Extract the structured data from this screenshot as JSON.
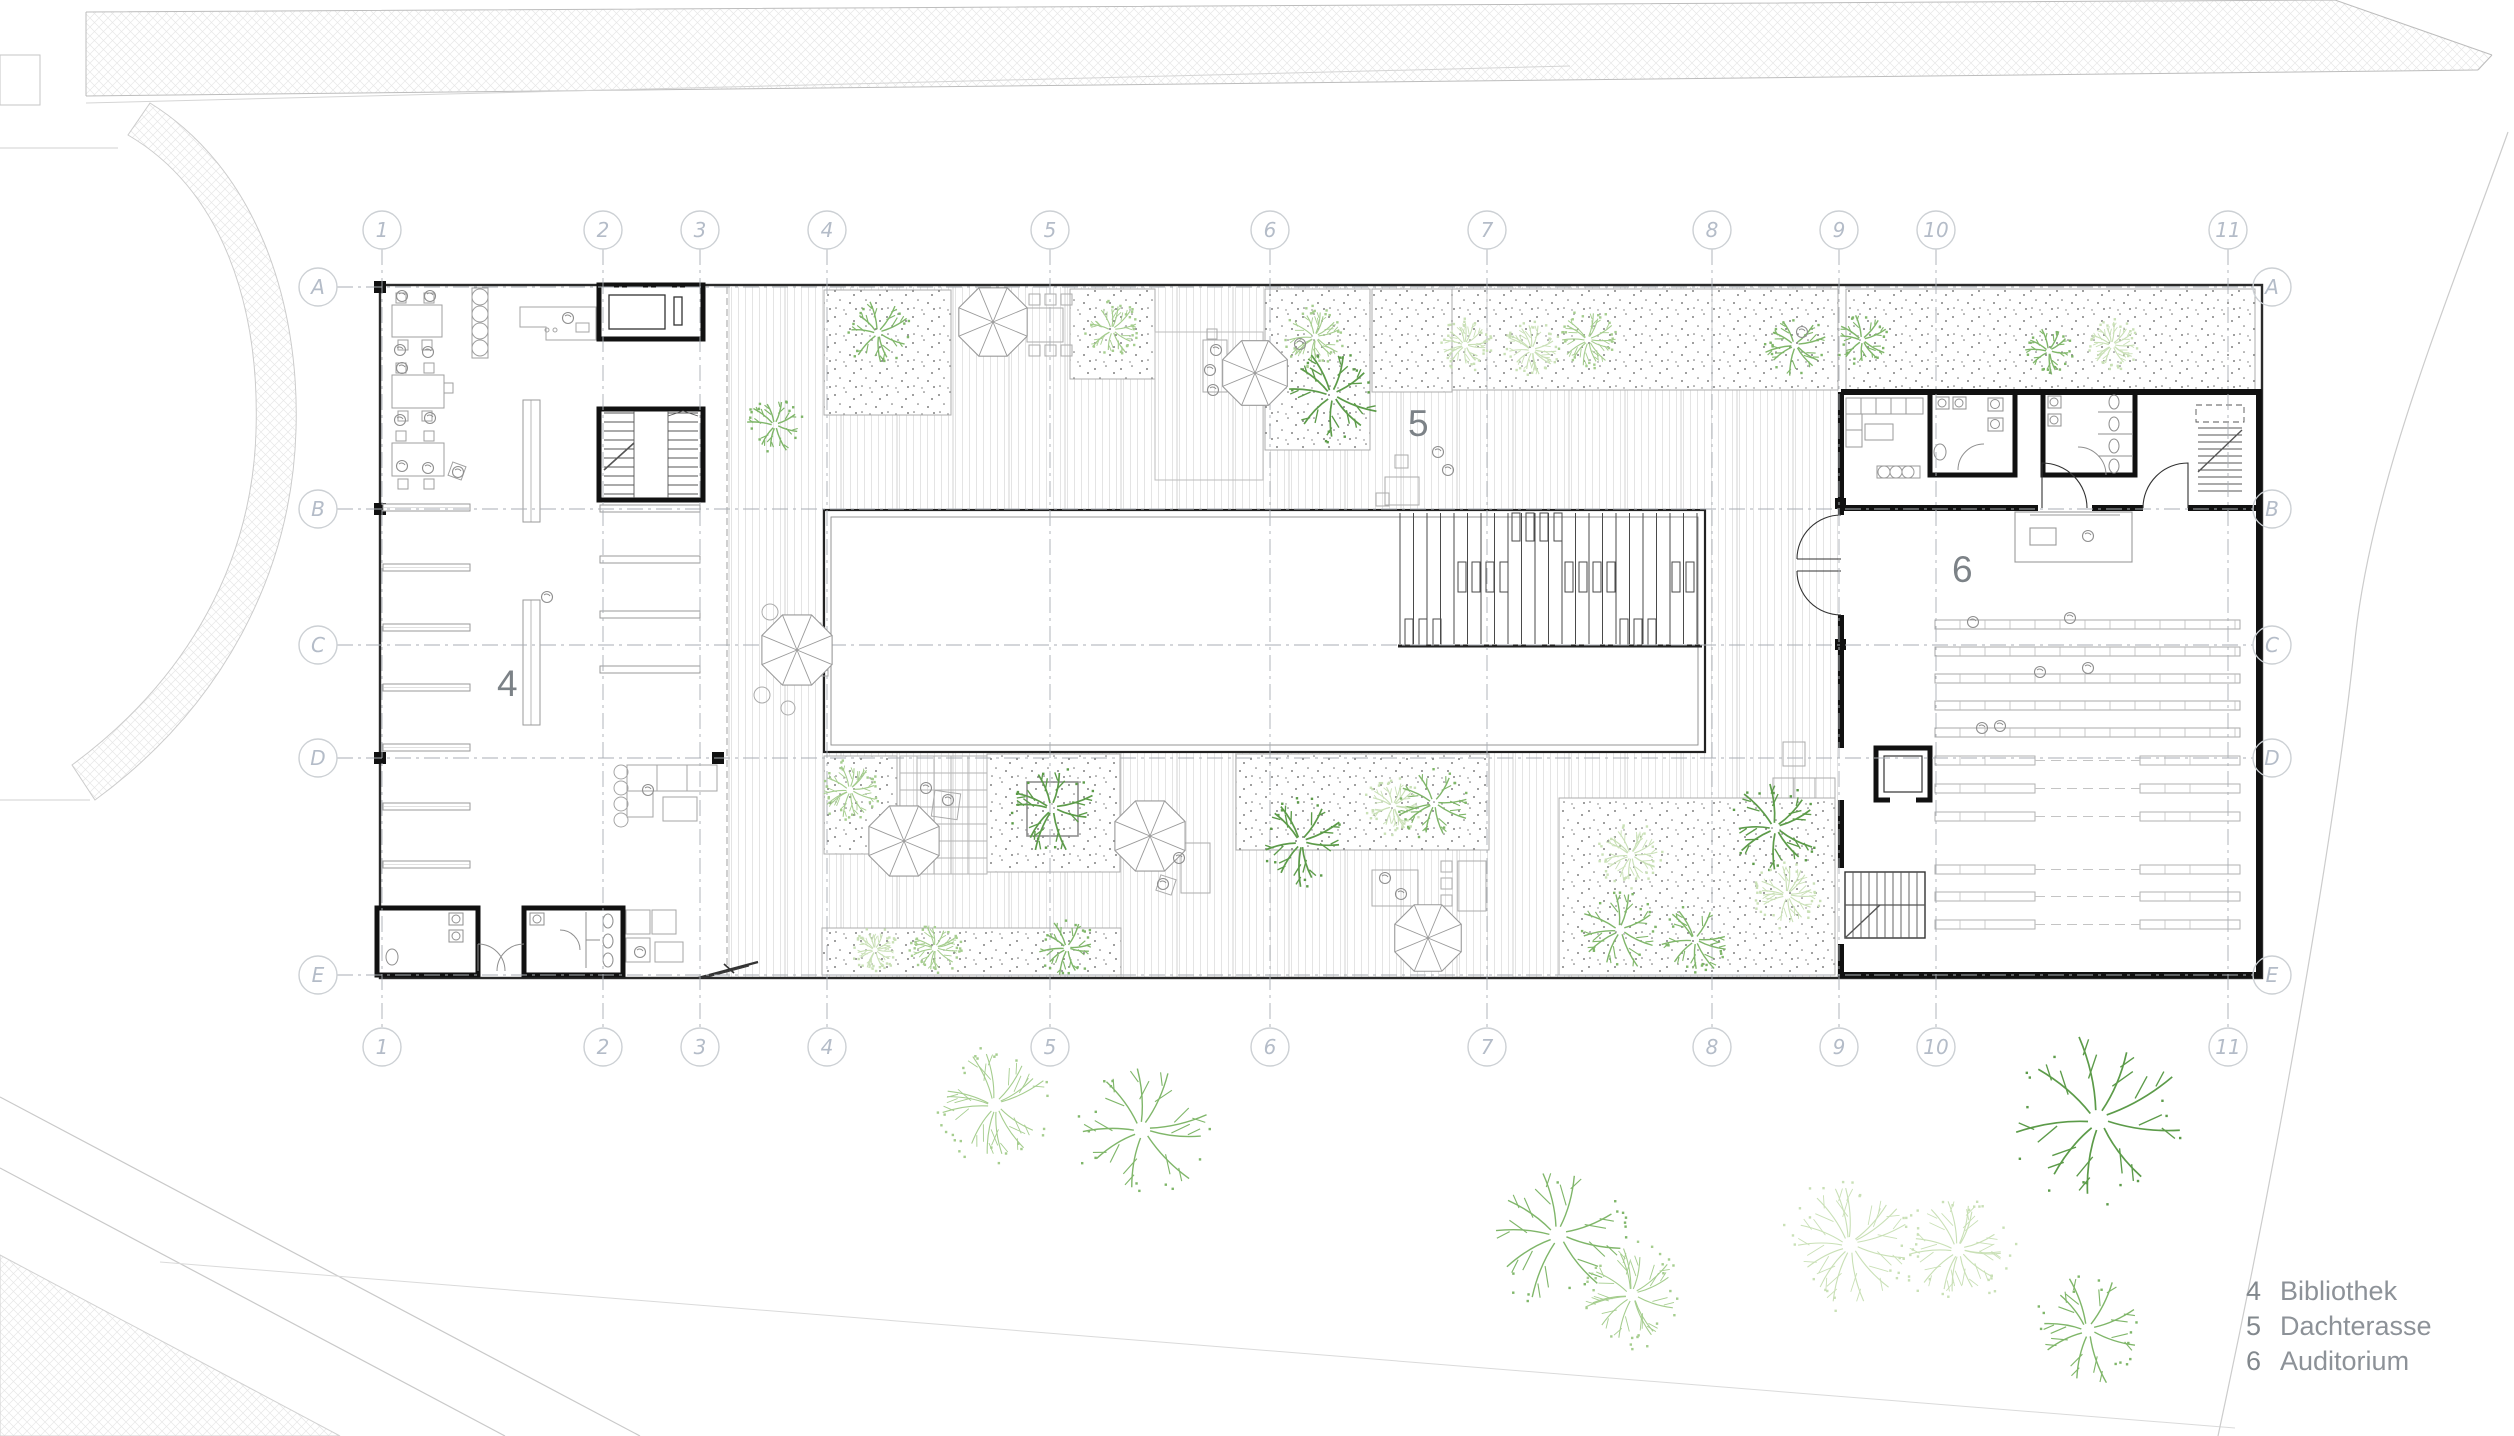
{
  "legend": {
    "items": [
      {
        "num": "4",
        "label": "Bibliothek"
      },
      {
        "num": "5",
        "label": "Dachterasse"
      },
      {
        "num": "6",
        "label": "Auditorium"
      }
    ]
  },
  "area_labels": [
    {
      "text": "4",
      "x": 497,
      "y": 696
    },
    {
      "text": "5",
      "x": 1408,
      "y": 436
    },
    {
      "text": "6",
      "x": 1952,
      "y": 582
    }
  ],
  "grid": {
    "columns": [
      {
        "label": "1",
        "x": 382
      },
      {
        "label": "2",
        "x": 603
      },
      {
        "label": "3",
        "x": 700
      },
      {
        "label": "4",
        "x": 827
      },
      {
        "label": "5",
        "x": 1050
      },
      {
        "label": "6",
        "x": 1270
      },
      {
        "label": "7",
        "x": 1487
      },
      {
        "label": "8",
        "x": 1712
      },
      {
        "label": "9",
        "x": 1839
      },
      {
        "label": "10",
        "x": 1936
      },
      {
        "label": "11",
        "x": 2228
      }
    ],
    "rows": [
      {
        "label": "A",
        "y": 287
      },
      {
        "label": "B",
        "y": 509
      },
      {
        "label": "C",
        "y": 645
      },
      {
        "label": "D",
        "y": 758
      },
      {
        "label": "E",
        "y": 975
      }
    ],
    "bubble_radius": 19,
    "top_bubble_y": 230,
    "bottom_bubble_y": 1047,
    "left_bubble_x": 318,
    "right_bubble_x": 2272
  },
  "colors": {
    "wall": "#1d1d1d",
    "line_medium": "#8f8f8f",
    "line_light": "#c9c9c9",
    "grid_line": "#a9aeb4",
    "bubble_stroke": "#ccd0d4",
    "bubble_text": "#b4bcc8",
    "area_label": "#7c8287",
    "legend_text": "#8d9298",
    "tree_dark": "#5c9b49",
    "tree_medium": "#7fb669",
    "tree_light": "#a5cd8e",
    "tree_verylight": "#c9e0b6"
  },
  "landscape": {
    "umbrellas": [
      {
        "x": 993,
        "y": 322,
        "r": 37
      },
      {
        "x": 1255,
        "y": 373,
        "r": 35
      },
      {
        "x": 797,
        "y": 650,
        "r": 38
      },
      {
        "x": 904,
        "y": 841,
        "r": 38
      },
      {
        "x": 1150,
        "y": 836,
        "r": 38
      },
      {
        "x": 1428,
        "y": 938,
        "r": 36
      }
    ],
    "trees": [
      {
        "x": 878,
        "y": 333,
        "r": 32,
        "type": "branch-med"
      },
      {
        "x": 1112,
        "y": 330,
        "r": 28,
        "type": "leafy-light"
      },
      {
        "x": 1315,
        "y": 337,
        "r": 30,
        "type": "leafy-light"
      },
      {
        "x": 1332,
        "y": 395,
        "r": 46,
        "type": "branch-dark"
      },
      {
        "x": 1465,
        "y": 345,
        "r": 26,
        "type": "leafy-vlight"
      },
      {
        "x": 1532,
        "y": 350,
        "r": 28,
        "type": "leafy-vlight"
      },
      {
        "x": 1588,
        "y": 340,
        "r": 30,
        "type": "leafy-light"
      },
      {
        "x": 1795,
        "y": 345,
        "r": 31,
        "type": "branch-med"
      },
      {
        "x": 1862,
        "y": 340,
        "r": 26,
        "type": "branch-med"
      },
      {
        "x": 2049,
        "y": 351,
        "r": 24,
        "type": "branch-med"
      },
      {
        "x": 2112,
        "y": 345,
        "r": 26,
        "type": "leafy-vlight"
      },
      {
        "x": 775,
        "y": 425,
        "r": 28,
        "type": "branch-med"
      },
      {
        "x": 850,
        "y": 790,
        "r": 30,
        "type": "leafy-light"
      },
      {
        "x": 1052,
        "y": 808,
        "r": 44,
        "type": "branch-dark"
      },
      {
        "x": 875,
        "y": 950,
        "r": 22,
        "type": "leafy-vlight"
      },
      {
        "x": 935,
        "y": 948,
        "r": 26,
        "type": "leafy-light"
      },
      {
        "x": 1067,
        "y": 948,
        "r": 28,
        "type": "branch-med"
      },
      {
        "x": 1301,
        "y": 842,
        "r": 44,
        "type": "branch-dark"
      },
      {
        "x": 1393,
        "y": 806,
        "r": 28,
        "type": "leafy-vlight"
      },
      {
        "x": 1434,
        "y": 803,
        "r": 36,
        "type": "branch-med"
      },
      {
        "x": 1631,
        "y": 855,
        "r": 32,
        "type": "leafy-vlight"
      },
      {
        "x": 1620,
        "y": 930,
        "r": 40,
        "type": "branch-med"
      },
      {
        "x": 1695,
        "y": 940,
        "r": 34,
        "type": "branch-med"
      },
      {
        "x": 1775,
        "y": 828,
        "r": 44,
        "type": "branch-dark"
      },
      {
        "x": 1787,
        "y": 895,
        "r": 33,
        "type": "leafy-vlight"
      },
      {
        "x": 995,
        "y": 1105,
        "r": 58,
        "type": "leafy-light"
      },
      {
        "x": 1142,
        "y": 1130,
        "r": 68,
        "type": "branch-med"
      },
      {
        "x": 1558,
        "y": 1235,
        "r": 72,
        "type": "branch-med"
      },
      {
        "x": 1632,
        "y": 1295,
        "r": 52,
        "type": "leafy-light"
      },
      {
        "x": 1850,
        "y": 1245,
        "r": 66,
        "type": "leafy-vlight"
      },
      {
        "x": 1958,
        "y": 1250,
        "r": 56,
        "type": "leafy-vlight"
      },
      {
        "x": 2098,
        "y": 1120,
        "r": 84,
        "type": "branch-dark"
      },
      {
        "x": 2088,
        "y": 1330,
        "r": 56,
        "type": "branch-med"
      }
    ],
    "persons": [
      [
        402,
        296
      ],
      [
        430,
        296
      ],
      [
        400,
        350
      ],
      [
        428,
        352
      ],
      [
        402,
        368
      ],
      [
        430,
        418
      ],
      [
        400,
        420
      ],
      [
        428,
        468
      ],
      [
        402,
        466
      ],
      [
        547,
        597
      ],
      [
        568,
        318
      ],
      [
        648,
        790
      ],
      [
        640,
        952
      ],
      [
        458,
        472
      ],
      [
        1216,
        350
      ],
      [
        1210,
        370
      ],
      [
        1213,
        390
      ],
      [
        1438,
        452
      ],
      [
        1448,
        470
      ],
      [
        1385,
        878
      ],
      [
        1401,
        894
      ],
      [
        1179,
        858
      ],
      [
        1163,
        884
      ],
      [
        926,
        788
      ],
      [
        948,
        800
      ],
      [
        1973,
        622
      ],
      [
        2070,
        618
      ],
      [
        2040,
        672
      ],
      [
        2088,
        668
      ],
      [
        1982,
        728
      ],
      [
        2000,
        726
      ],
      [
        2088,
        536
      ],
      [
        1300,
        344
      ],
      [
        1802,
        332
      ]
    ]
  }
}
